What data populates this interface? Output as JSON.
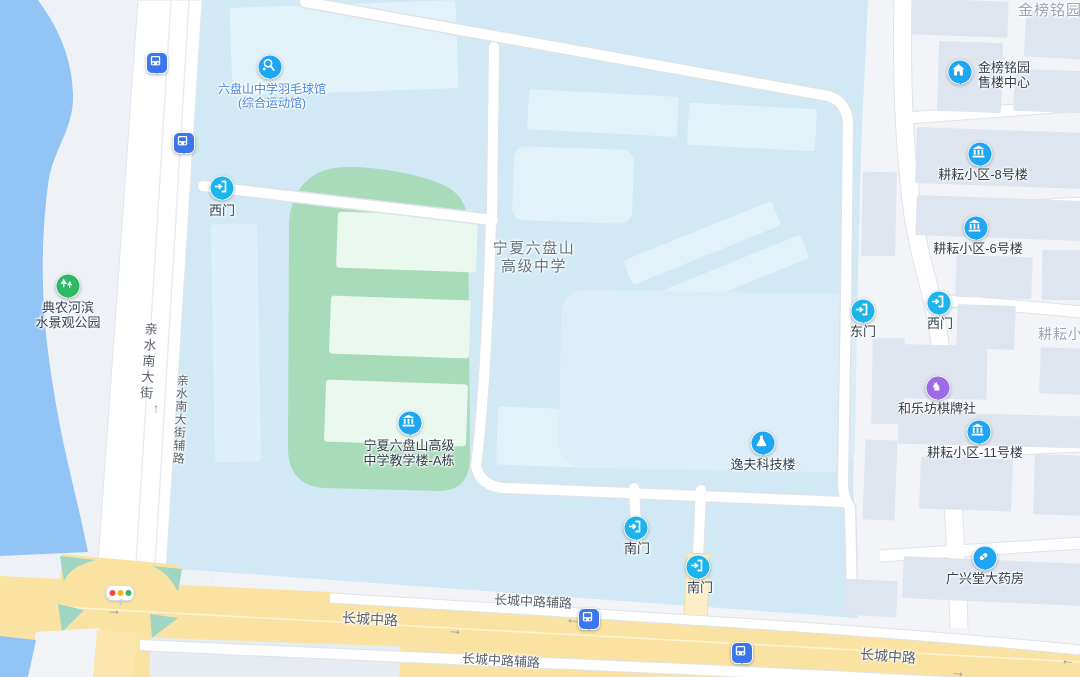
{
  "app": "map-view",
  "labels": {
    "school_line1": "宁夏六盘山",
    "school_line2": "高级中学",
    "gym_line1": "六盘山中学羽毛球馆",
    "gym_line2": "(综合运动馆)",
    "park_line1": "典农河滨",
    "park_line2": "水景观公园",
    "teaching_line1": "宁夏六盘山高级",
    "teaching_line2": "中学教学楼-A栋",
    "yifu": "逸夫科技楼",
    "sales_line1": "金榜铭园",
    "sales_line2": "售楼中心",
    "bldg8": "耕耘小区-8号楼",
    "bldg6": "耕耘小区-6号楼",
    "bldg11": "耕耘小区-11号楼",
    "chess_club": "和乐坊棋牌社",
    "pharmacy": "广兴堂大药房",
    "jinbang_area": "金榜铭园",
    "gengyun_area": "耕耘小区",
    "gate_west_campus": "西门",
    "gate_east_campus": "东门",
    "gate_west_community": "西门",
    "gate_south_1": "南门",
    "gate_south_2": "南门",
    "qinshui_street": "亲水南大街",
    "qinshui_frontage": "亲水南大街辅路",
    "changcheng_1": "长城中路",
    "changcheng_2": "长城中路",
    "changcheng_frontage_1": "长城中路辅路",
    "changcheng_frontage_2": "长城中路辅路"
  },
  "glyphs": {
    "arrow_up": "↑",
    "arrow_left": "←",
    "arrow_right": "→"
  },
  "icons": {
    "bus": "bus-stop-pin",
    "gate": "gate-door-pin",
    "building": "building-columns-pin",
    "house": "house-pin",
    "sports": "badminton-racket-pin",
    "park": "trees-pin",
    "chess": "chess-knight-pin",
    "pill": "capsule-pin",
    "flask": "flask-pin",
    "traffic_light": "traffic-light-icon"
  },
  "colors": {
    "water": "#92c4f5",
    "campus": "#d0e9f4",
    "campus_building": "#e3f2f9",
    "field_green": "#a7dbb9",
    "field_building": "#eaf8f0",
    "main_road_yellow": "#fae3a2",
    "teal_corner": "#9fd6c3",
    "right_building": "#dee5ef",
    "poi_blue": "#1ea6f3",
    "gate_cyan": "#1db4eb",
    "bus_blue": "#3c76ec",
    "park_green": "#2eb964",
    "chess_purple": "#9c6be5"
  }
}
